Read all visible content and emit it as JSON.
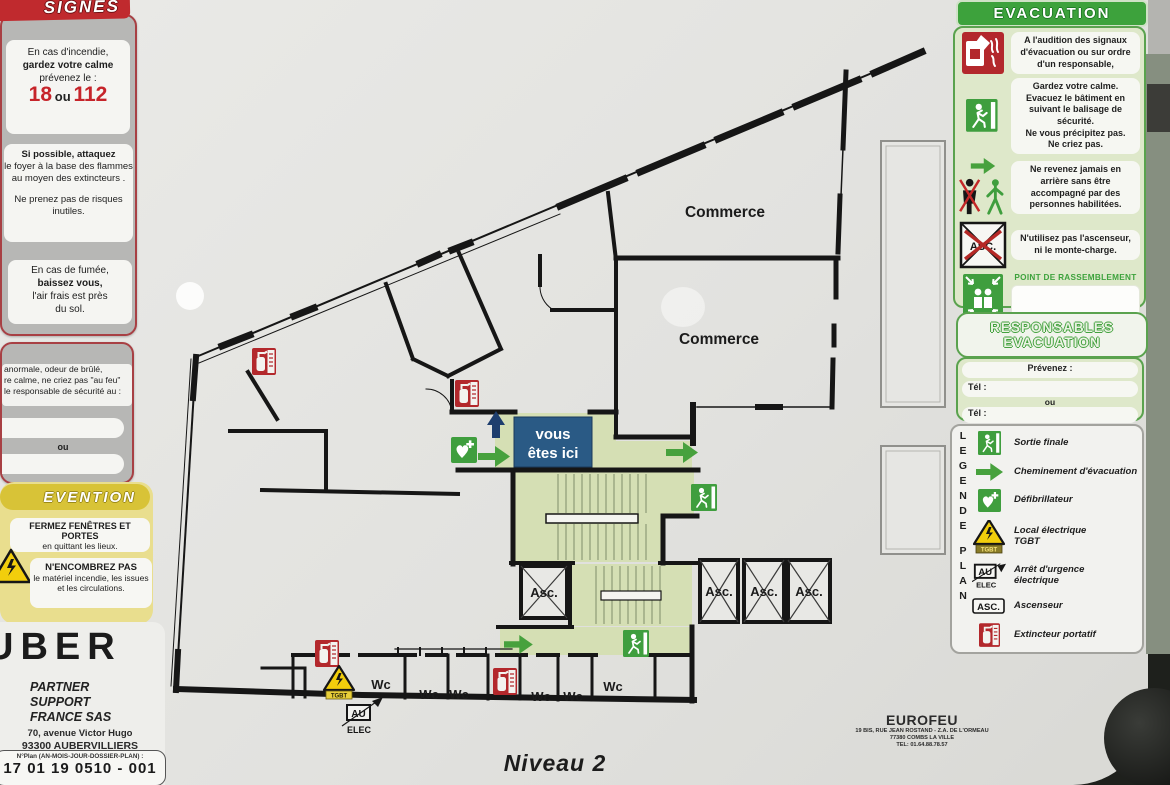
{
  "header": {
    "signes": "SIGNES",
    "evacuation": "EVACUATION"
  },
  "left": {
    "fire": {
      "l1": "En cas d'incendie,",
      "l2": "gardez votre calme",
      "l3": "prévenez le :",
      "n1": "18",
      "ou": "ou",
      "n2": "112"
    },
    "attack": {
      "p1a": "Si possible, attaquez",
      "p1b": "le foyer à la base des flammes au moyen des extincteurs .",
      "p2a": "Ne prenez pas de risques",
      "p2b": "inutiles."
    },
    "smoke": {
      "l1": "En cas de fumée,",
      "l2": "baissez vous,",
      "l3": "l'air frais est près",
      "l4": "du sol."
    },
    "alert": {
      "l1": "anormale, odeur de brûlé,",
      "l2": "re calme, ne criez pas \"au feu\"",
      "l3": "le responsable de sécurité au :",
      "ou": "ou"
    },
    "prevention": {
      "header": "EVENTION",
      "b1a": "FERMEZ FENÊTRES ET PORTES",
      "b1b": "en quittant les lieux.",
      "b2a": "N'ENCOMBREZ PAS",
      "b2b": "le matériel incendie, les issues",
      "b2c": "et les circulations."
    },
    "company": {
      "name": "UBER",
      "l1": "PARTNER",
      "l2": "SUPPORT",
      "l3": "FRANCE SAS",
      "addr1": "70, avenue Victor Hugo",
      "addr2": "93300 AUBERVILLIERS",
      "plan_label": "N°Plan (AN-MOIS-JOUR-DOSSIER-PLAN) :",
      "plan_number": "17 01 19 0510 - 001"
    }
  },
  "evac": {
    "r1": "A l'audition des signaux d'évacuation ou sur ordre d'un responsable,",
    "r2a": "Gardez votre calme.",
    "r2b": "Evacuez le bâtiment en suivant le balisage de sécurité.",
    "r2c": "Ne vous précipitez pas.",
    "r2d": "Ne criez pas.",
    "r3": "Ne revenez jamais en arrière sans être accompagné par des personnes habilitées.",
    "r4": "N'utilisez pas l'ascenseur, ni le monte-charge.",
    "assembly": "POINT DE RASSEMBLEMENT",
    "asc_label": "ASC."
  },
  "responsables": {
    "h1": "RESPONSABLES",
    "h2": "EVACUATION",
    "prevenez": "Prévenez :",
    "tel1": "Tél :",
    "ou": "ou",
    "tel2": "Tél :"
  },
  "legend": {
    "v1": "LEGENDE",
    "v2": "PLAN",
    "i1": "Sortie finale",
    "i2": "Cheminement d'évacuation",
    "i3": "Défibrillateur",
    "i4a": "Local électrique",
    "i4b": "TGBT",
    "i5a": "Arrêt d'urgence",
    "i5b": "électrique",
    "i6": "Ascenseur",
    "i7": "Extincteur portatif",
    "au": "AU",
    "elec": "ELEC",
    "asc": "ASC.",
    "tgbt": "TGBT"
  },
  "plan": {
    "commerce": "Commerce",
    "asc": "Asc.",
    "wc": "Wc",
    "here1": "vous",
    "here2": "êtes ici",
    "au": "AU",
    "elec": "ELEC",
    "tgbt": "TGBT",
    "level": "Niveau 2"
  },
  "installer": {
    "name": "EUROFEU",
    "a1": "19 BIS, RUE JEAN ROSTAND - Z.A. DE L'ORMEAU",
    "a2": "77380 COMBS LA VILLE",
    "a3": "TEL: 01.64.88.78.57"
  },
  "colors": {
    "green": "#3da23c",
    "light_green_panel": "#dee8ca",
    "plan_green": "#d5dfb4",
    "red": "#c02a2e",
    "navy": "#2a5a85",
    "yellow": "#f2ce0c"
  }
}
